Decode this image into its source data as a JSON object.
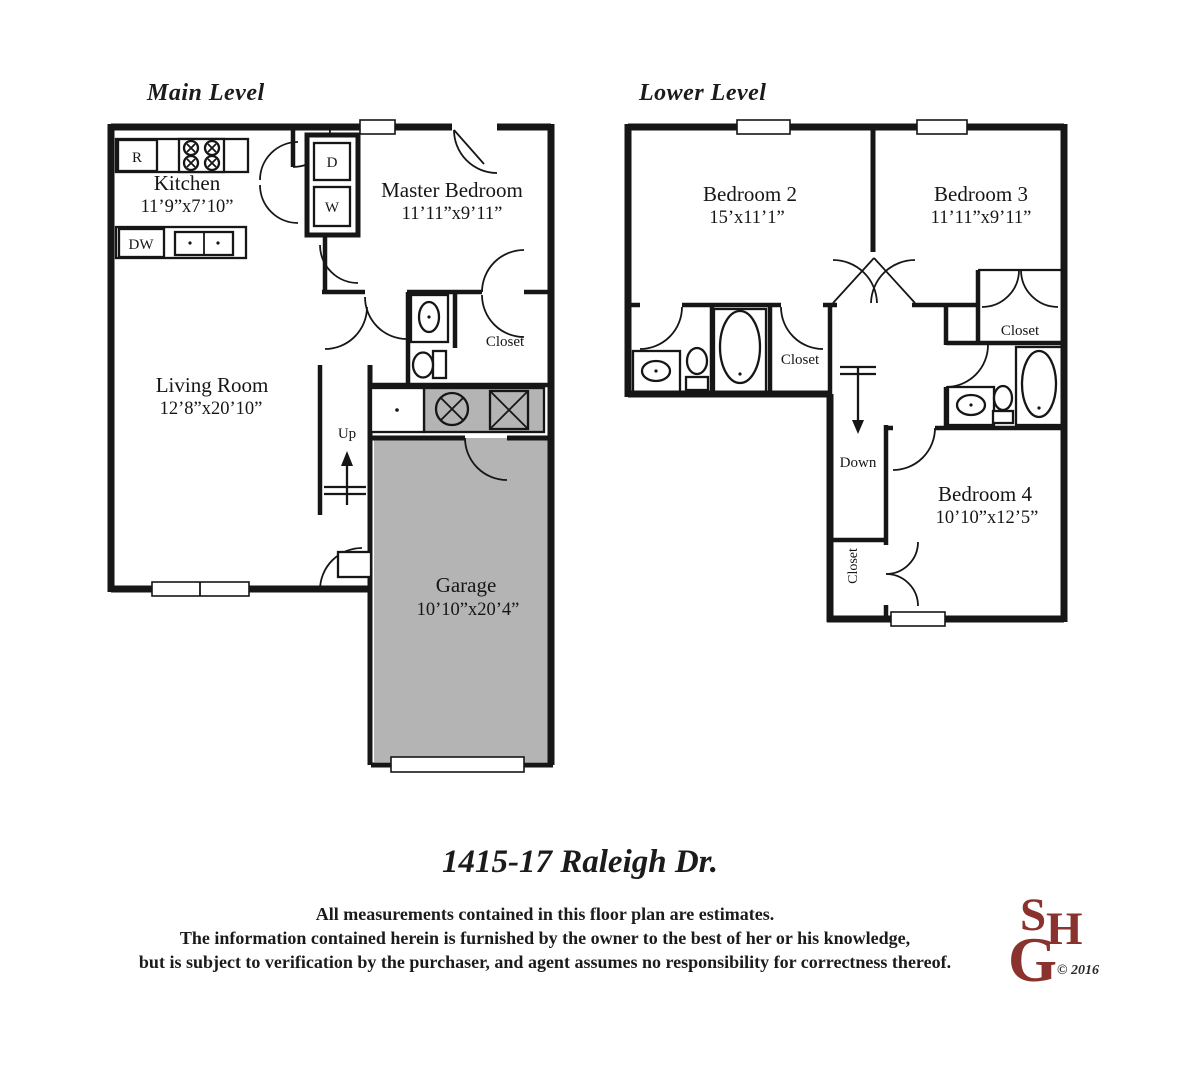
{
  "plans": {
    "main": {
      "title": "Main Level",
      "kitchen": {
        "name": "Kitchen",
        "dims": "11’9”x7’10”"
      },
      "master_bedroom": {
        "name": "Master Bedroom",
        "dims": "11’11”x9’11”"
      },
      "living_room": {
        "name": "Living Room",
        "dims": "12’8”x20’10”"
      },
      "garage": {
        "name": "Garage",
        "dims": "10’10”x20’4”"
      },
      "closet_label": "Closet",
      "stairs_label": "Up",
      "appliances": {
        "range": "R",
        "dishwasher": "DW",
        "dryer": "D",
        "washer": "W"
      }
    },
    "lower": {
      "title": "Lower Level",
      "bedroom2": {
        "name": "Bedroom 2",
        "dims": "15’x11’1”"
      },
      "bedroom3": {
        "name": "Bedroom 3",
        "dims": "11’11”x9’11”"
      },
      "bedroom4": {
        "name": "Bedroom 4",
        "dims": "10’10”x12’5”"
      },
      "closet_hall_label": "Closet",
      "closet_bedroom3_label": "Closet",
      "closet_bedroom4_label": "Closet",
      "stairs_label": "Down"
    }
  },
  "footer": {
    "address": "1415-17 Raleigh Dr.",
    "disclaimer_line1": "All measurements contained in this floor plan are estimates.",
    "disclaimer_line2": "The information contained herein is furnished by the owner to the best of her or his knowledge,",
    "disclaimer_line3": "but is subject to verification by the purchaser, and agent assumes no responsibility for correctness thereof.",
    "logo": {
      "letter_s": "S",
      "letter_h": "H",
      "letter_g": "G",
      "copyright": "© 2016"
    }
  },
  "colors": {
    "ink": "#161616",
    "garage_fill": "#b4b4b4",
    "logo_red": "#8a332e"
  }
}
